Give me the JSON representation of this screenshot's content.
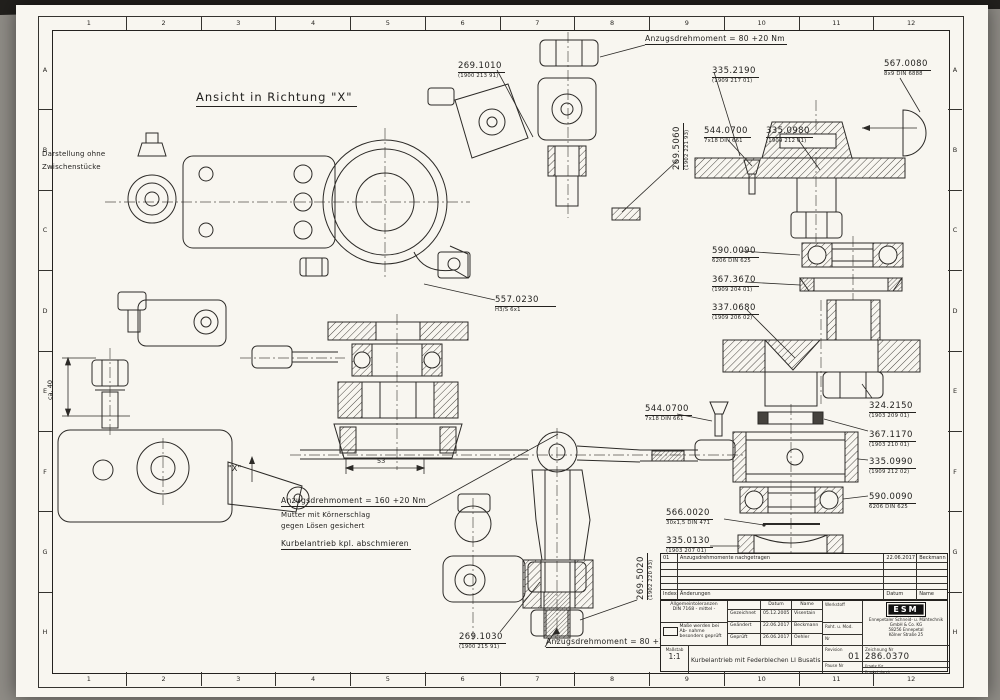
{
  "frame": {
    "cols": [
      "1",
      "2",
      "3",
      "4",
      "5",
      "6",
      "7",
      "8",
      "9",
      "10",
      "11",
      "12"
    ],
    "rows": [
      "A",
      "B",
      "C",
      "D",
      "E",
      "F",
      "G",
      "H"
    ]
  },
  "view": {
    "title": "Ansicht in Richtung \"X\"",
    "note1": "Darstellung ohne",
    "note2": "Zwischenstücke",
    "x_marker": "\"X\""
  },
  "notes": {
    "torque_top": "Anzugsdrehmoment = 80 +20 Nm",
    "torque_mid": "Anzugsdrehmoment = 160 +20 Nm",
    "secure1": "Mutter mit Körnerschlag",
    "secure2": "gegen Lösen gesichert",
    "grease": "Kurbelantrieb kpl. abschmieren",
    "torque_bottom": "Anzugsdrehmoment = 80 +20 Nm"
  },
  "dims": {
    "d53": "53",
    "d40": "ca. 40"
  },
  "parts": [
    {
      "no": "269.1010",
      "spec": "(1900 213 91)"
    },
    {
      "no": "335.2190",
      "spec": "(1909 217 01)"
    },
    {
      "no": "567.0080",
      "spec": "8x9 DIN 6888"
    },
    {
      "no": "269.5060",
      "spec": "(1902 221 93)"
    },
    {
      "no": "544.0700",
      "spec": "7x18 DIN 661"
    },
    {
      "no": "335.0980",
      "spec": "(1909 212 01)"
    },
    {
      "no": "590.0090",
      "spec": "6206 DIN 625"
    },
    {
      "no": "367.3670",
      "spec": "(1909 204 01)"
    },
    {
      "no": "337.0680",
      "spec": "(1909 206 02)"
    },
    {
      "no": "557.0230",
      "spec": "H3/S 6x1"
    },
    {
      "no": "324.2150",
      "spec": "(1903 209 01)"
    },
    {
      "no": "544.0700",
      "spec": "7x18 DIN 661"
    },
    {
      "no": "367.1170",
      "spec": "(1903 210 01)"
    },
    {
      "no": "335.0990",
      "spec": "(1909 212 02)"
    },
    {
      "no": "590.0090",
      "spec": "6206 DIN 625"
    },
    {
      "no": "566.0020",
      "spec": "30x1,5 DIN 471"
    },
    {
      "no": "335.0130",
      "spec": "(1903 207 01)"
    },
    {
      "no": "269.5020",
      "spec": "(1902 220 93)"
    },
    {
      "no": "269.1030",
      "spec": "(1900 215 91)"
    }
  ],
  "revisions": {
    "entry": {
      "index": "01",
      "text": "Anzugsdrehmomente nachgetragen",
      "date": "22.06.2017",
      "name": "Beckmann"
    },
    "header": {
      "index": "Index",
      "text": "Änderungen",
      "date": "Datum",
      "name": "Name"
    }
  },
  "titleblock": {
    "tol1": "Allgemeintoleranzen",
    "tol2": "DIN 7168",
    "tol3": "- mittel -",
    "check1": "Maße werden bei Ab-",
    "check2": "nahme besonders geprüft",
    "col_date": "Datum",
    "col_name": "Name",
    "rows": [
      {
        "label": "Gezeichnet",
        "date": "05.12.2005",
        "name": "Visentain"
      },
      {
        "label": "Geändert",
        "date": "22.06.2017",
        "name": "Beckmann"
      },
      {
        "label": "Geprüft",
        "date": "26.06.2017",
        "name": "Oehler"
      }
    ],
    "material": "Werkstoff",
    "blank": "Roht. u. Mod.",
    "nr": "Nr",
    "logo": "ESM",
    "co1": "Ennepetaler Schneid- u. Mähtechnik",
    "co2": "GmbH & Co. KG",
    "co3": "58256 Ennepetal",
    "co4": "Kölner Straße 25",
    "scale_label": "Maßstab",
    "scale": "1:1",
    "title": "Kurbelantrieb mit Federblechen LI Busatis",
    "rev_label": "Revision",
    "rev": "01",
    "dno_label": "Zeichnung Nr",
    "dno": "286.0370",
    "pause": "Pause Nr",
    "ersatz": "Ersatz für",
    "ersetzt": "Ersetzt durch"
  }
}
